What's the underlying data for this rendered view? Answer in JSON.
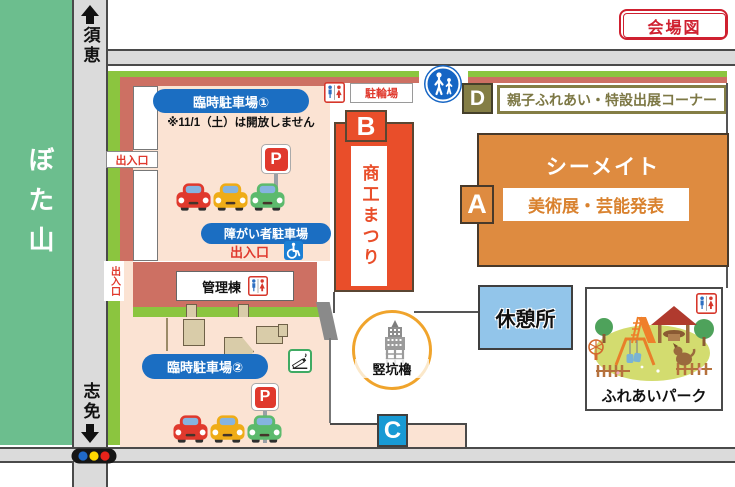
{
  "venue_badge": {
    "label": "会場図",
    "color": "#cf2030"
  },
  "hill": {
    "label": "ぼた山",
    "color": "#6cbe8e"
  },
  "roads": {
    "north": "須恵",
    "south": "志免"
  },
  "traffic_light": {
    "colors": [
      "#2069c8",
      "#ffd900",
      "#e8231a"
    ]
  },
  "border": {
    "green": "#8bc53f",
    "salmon": "#cd7063"
  },
  "parking1": {
    "name": "臨時駐車場①",
    "note": "※11/1（土）は開放しません",
    "gate": "出入口",
    "p_sign": "P",
    "disabled_name": "障がい者駐車場",
    "disabled_gate": "出入口"
  },
  "side_gate": {
    "label": "出入口"
  },
  "admin": {
    "label": "管理棟"
  },
  "parking2": {
    "name": "臨時駐車場②",
    "p_sign": "P"
  },
  "cars": {
    "colors": [
      "#e0392d",
      "#efac17",
      "#5cba6d"
    ]
  },
  "festival": {
    "badge": "B",
    "name": "商工まつり",
    "color": "#e94e2a"
  },
  "bicycle": {
    "label": "駐輪場"
  },
  "corner_d": {
    "badge": "D",
    "label": "親子ふれあい・特設出展コーナー",
    "color": "#847e45"
  },
  "seamate": {
    "badge": "A",
    "name": "シーメイト",
    "event": "美術展・芸能発表",
    "color": "#de8b40"
  },
  "rest_area": {
    "label": "休憩所",
    "color": "#92c5ea"
  },
  "tower": {
    "label": "竪坑櫓"
  },
  "exit_c": {
    "badge": "C",
    "color": "#189ad4"
  },
  "park": {
    "label": "ふれあいパーク"
  }
}
